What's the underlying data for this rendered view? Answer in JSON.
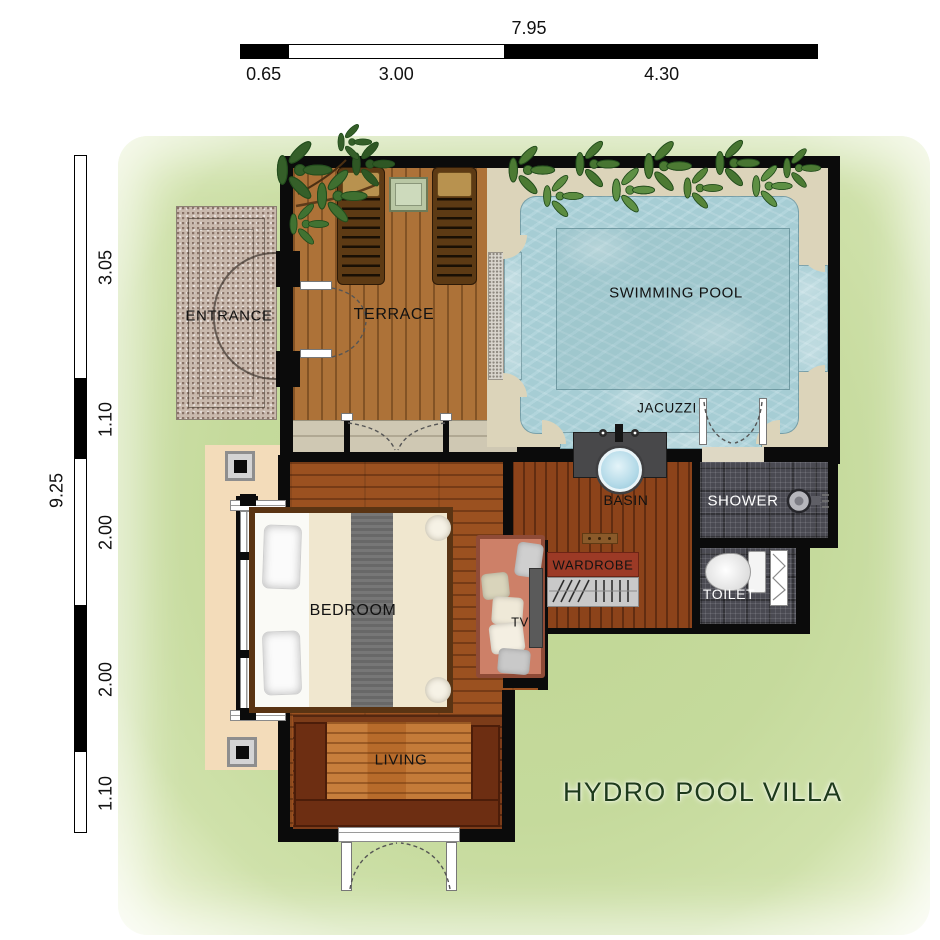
{
  "title": {
    "text": "HYDRO POOL VILLA"
  },
  "scales": {
    "top": {
      "total": "7.95",
      "segments": [
        {
          "value": "0.65"
        },
        {
          "value": "3.00"
        },
        {
          "value": "4.30"
        }
      ]
    },
    "left": {
      "total": "9.25",
      "segments": [
        {
          "value": "3.05"
        },
        {
          "value": "1.10"
        },
        {
          "value": "2.00"
        },
        {
          "value": "2.00"
        },
        {
          "value": "1.10"
        }
      ]
    }
  },
  "rooms": {
    "entrance": {
      "label": "ENTRANCE"
    },
    "terrace": {
      "label": "TERRACE"
    },
    "swimming_pool": {
      "label": "SWIMMING POOL"
    },
    "jacuzzi": {
      "label": "JACUZZI"
    },
    "basin": {
      "label": "BASIN"
    },
    "shower": {
      "label": "SHOWER"
    },
    "wardrobe": {
      "label": "WARDROBE"
    },
    "toilet": {
      "label": "TOILET"
    },
    "bedroom": {
      "label": "BEDROOM"
    },
    "tv": {
      "label": "TV"
    },
    "living": {
      "label": "LIVING"
    }
  },
  "colors": {
    "lawn": "#c5da9c",
    "wall": "#0b0b0b",
    "deck": "#dcd4ba",
    "steps": "#cfc8b3",
    "walkway": "#f3dcba",
    "granite": "#c9b9ad",
    "water": "#a6cdd4",
    "terrace_wood": "#ad7238",
    "bedroom_wood": "#9b5120",
    "basin_wood": "#8c431a",
    "living_wood": "#7c3c19",
    "living_center": "#b76b2b",
    "seat": "#6d2e12",
    "tile": "#4a4a52",
    "sofa": "#cd8068",
    "wardrobe_red": "#9c3a26",
    "bed_frame": "#5a3413",
    "duvet": "#f0e7cf",
    "runner": "#6f6f6f",
    "plant_green": "#4c7a33",
    "tree_green": "#35612a",
    "title_green": "#1d3a1b"
  }
}
